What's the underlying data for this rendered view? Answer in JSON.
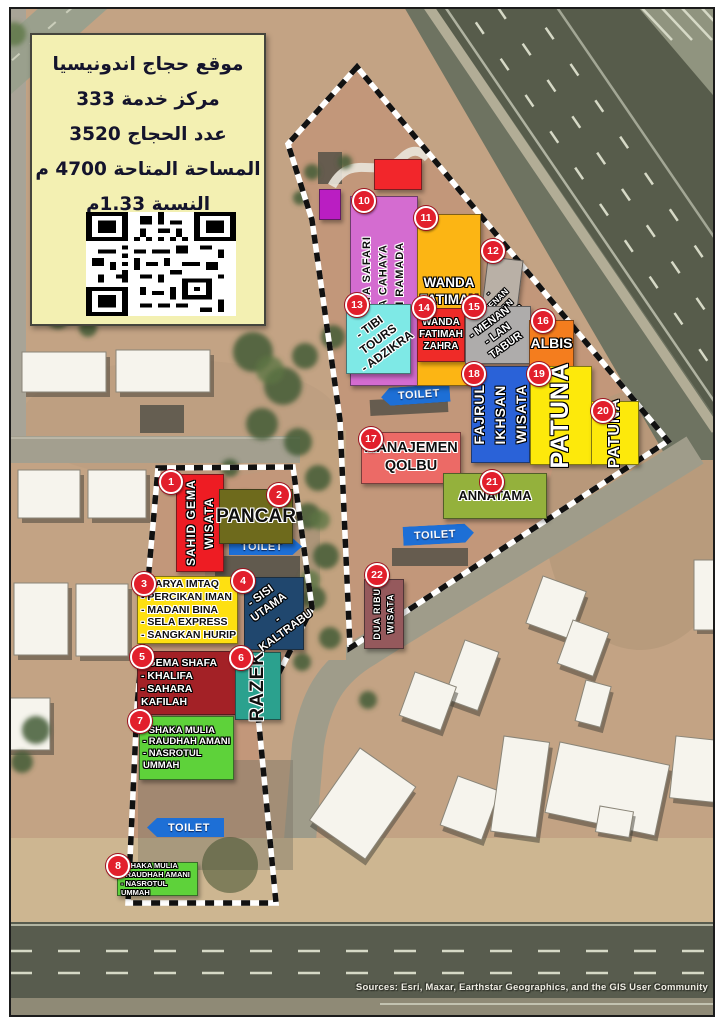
{
  "info_panel": {
    "lines": [
      "موقع حجاج اندونيسيا",
      "مركز خدمة 333",
      "عدد الحجاج 3520",
      "المساحة المتاحة 4700 م",
      "النسبة 1.33م"
    ],
    "panel_color": "#f3f0b2"
  },
  "toilet_label": "TOILET",
  "toilet_color": "#1d6fd6",
  "badge_color": "#e21f2c",
  "attribution": "Sources: Esri, Maxar, Earthstar Geographics, and the GIS User Community",
  "blocks": [
    {
      "num": "1",
      "label": "SAHID GEMA WISATA",
      "color": "#ee1c23",
      "text_color": "#ffffff"
    },
    {
      "num": "2",
      "label": "PANCAR",
      "color": "#6e6a1c",
      "text_color": "#111111"
    },
    {
      "num": "3",
      "label": "- KARYA IMTAQ\n- PERCIKAN IMAN\n- MADANI BINA\n- SELA EXPRESS\n- SANGKAN HURIP",
      "color": "#fee011",
      "text_color": "#111111"
    },
    {
      "num": "4",
      "label": "- SISI UTAMA\n- KALTRABU",
      "color": "#20476e",
      "text_color": "#ffffff"
    },
    {
      "num": "5",
      "label": "- GEMA SHAFA\n- KHALIFA\n- SAHARA KAFILAH",
      "color": "#a32126",
      "text_color": "#ffffff"
    },
    {
      "num": "6",
      "label": "RAZEK",
      "color": "#2ba18e",
      "text_color": "#111111"
    },
    {
      "num": "7",
      "label": "- SHAKA MULIA\n- RAUDHAH AMANI\n- NASROTUL UMMAH",
      "color": "#5ed23a",
      "text_color": "#ffffff"
    },
    {
      "num": "8",
      "label": "- SHAKA MULIA\n- RAUDHAH AMANI\n- NASROTUL UMMAH",
      "color": "#5ed23a",
      "text_color": "#ffffff"
    },
    {
      "num": "10",
      "label": "- HUDAYA SAFARI\n- TIGA CAHAYA\n- SARI RAMADA",
      "color": "#d46cd0",
      "text_color": "#111111"
    },
    {
      "num": "11",
      "label": "WANDA\nFATIMAH\nZAHRA",
      "color": "#fcb514",
      "text_color": "#ffffff"
    },
    {
      "num": "12",
      "label": "- MENAN\n- LAN TABUR",
      "color": "#b9b0a6",
      "text_color": "#ffffff"
    },
    {
      "num": "13",
      "label": "- TIBI TOURS\n- ADZIKRA",
      "color": "#7ee9e6",
      "text_color": "#111111"
    },
    {
      "num": "14",
      "label": "WANDA\nFATIMAH\nZAHRA",
      "color": "#ef2b28",
      "text_color": "#ffffff"
    },
    {
      "num": "15",
      "label": "- MENAN\n- LAN TABUR",
      "color": "#aeacab",
      "text_color": "#ffffff"
    },
    {
      "num": "16",
      "label": "ALBIS",
      "color": "#f47d1e",
      "text_color": "#ffffff"
    },
    {
      "num": "17",
      "label": "MANAJEMEN\nQOLBU",
      "color": "#ec6a66",
      "text_color": "#111111"
    },
    {
      "num": "18",
      "label": "FAJRUL\nIKHSAN\nWISATA",
      "color": "#2a62d8",
      "text_color": "#ffffff"
    },
    {
      "num": "19",
      "label": "PATUNA",
      "color": "#fde90b",
      "text_color": "#ffffff"
    },
    {
      "num": "20",
      "label": "PATUNA",
      "color": "#fde90b",
      "text_color": "#ffffff"
    },
    {
      "num": "21",
      "label": "ANNATAMA",
      "color": "#94b13c",
      "text_color": "#111111"
    },
    {
      "num": "22",
      "label": "DUA RIBU\nWISATA",
      "color": "#95595c",
      "text_color": "#ffffff"
    },
    {
      "num": "",
      "label": "",
      "color": "#f2262b",
      "text_color": ""
    },
    {
      "num": "",
      "label": "",
      "color": "#ba1ec2",
      "text_color": ""
    }
  ]
}
